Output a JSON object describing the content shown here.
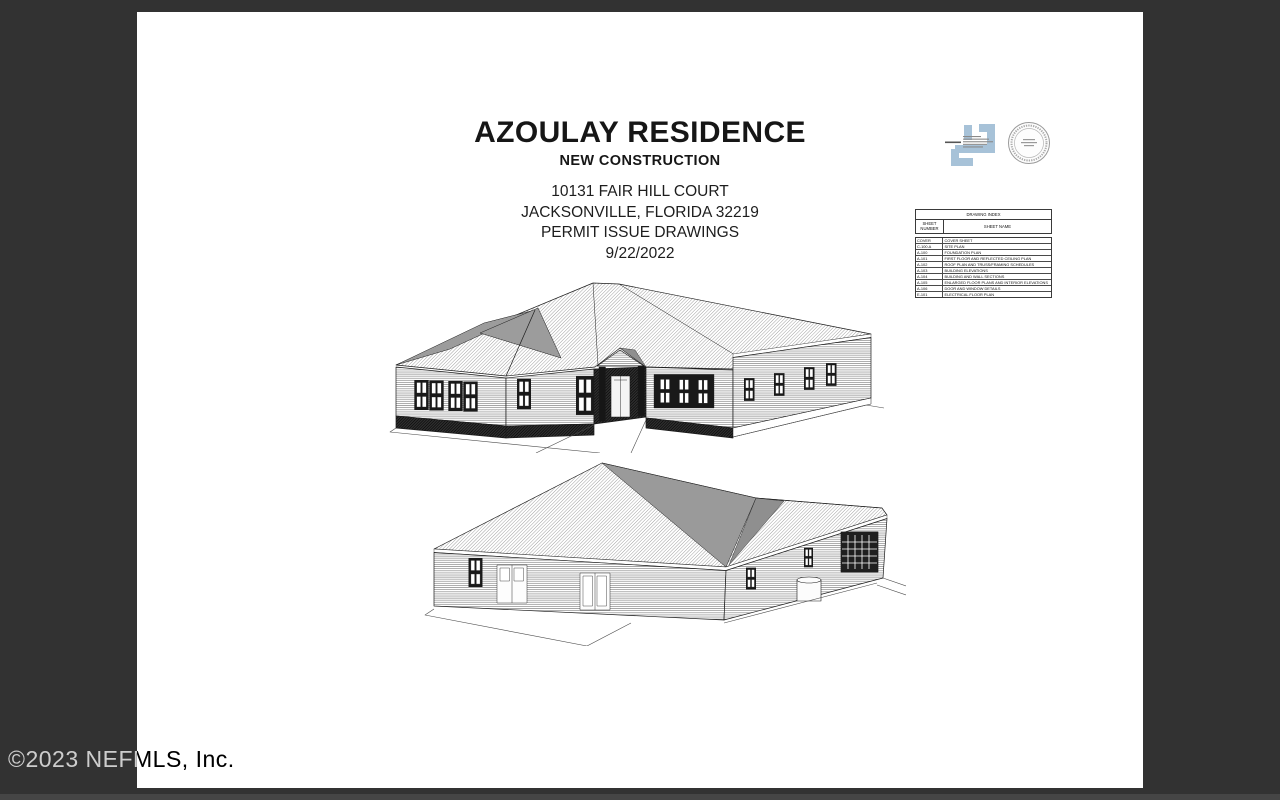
{
  "title_block": {
    "title": "AZOULAY RESIDENCE",
    "subtitle": "NEW CONSTRUCTION",
    "address_line1": "10131 FAIR HILL COURT",
    "address_line2": "JACKSONVILLE, FLORIDA 32219",
    "set_label": "PERMIT ISSUE DRAWINGS",
    "date": "9/22/2022"
  },
  "drawing_index": {
    "title": "DRAWING INDEX",
    "col_number": "SHEET NUMBER",
    "col_name": "SHEET NAME",
    "rows": [
      {
        "number": "COVER",
        "name": "COVER SHEET"
      },
      {
        "number": "C-100.A",
        "name": "SITE PLAN"
      },
      {
        "number": "A-100",
        "name": "FOUNDATION PLAN"
      },
      {
        "number": "A-101",
        "name": "FIRST FLOOR AND REFLECTED CEILING PLAN"
      },
      {
        "number": "A-102",
        "name": "ROOF PLAN AND TRUSS/FRAMING SCHEDULES"
      },
      {
        "number": "A-103",
        "name": "BUILDING ELEVATIONS"
      },
      {
        "number": "A-104",
        "name": "BUILDING AND WALL SECTIONS"
      },
      {
        "number": "A-105",
        "name": "ENLARGED FLOOR PLANS AND INTERIOR ELEVATIONS"
      },
      {
        "number": "A-106",
        "name": "DOOR AND WINDOW DETAILS"
      },
      {
        "number": "E-101",
        "name": "ELECTRICAL FLOOR PLAN"
      }
    ]
  },
  "watermark": "©2023 NEFMLS, Inc.",
  "icons": {
    "architect_logo": "interlocking-squares-logo",
    "seal": "circular-architect-seal"
  },
  "colors": {
    "background": "#323232",
    "page": "#ffffff",
    "logo_blue": "#a7c2d8",
    "line_art": "#1c1c1c"
  }
}
